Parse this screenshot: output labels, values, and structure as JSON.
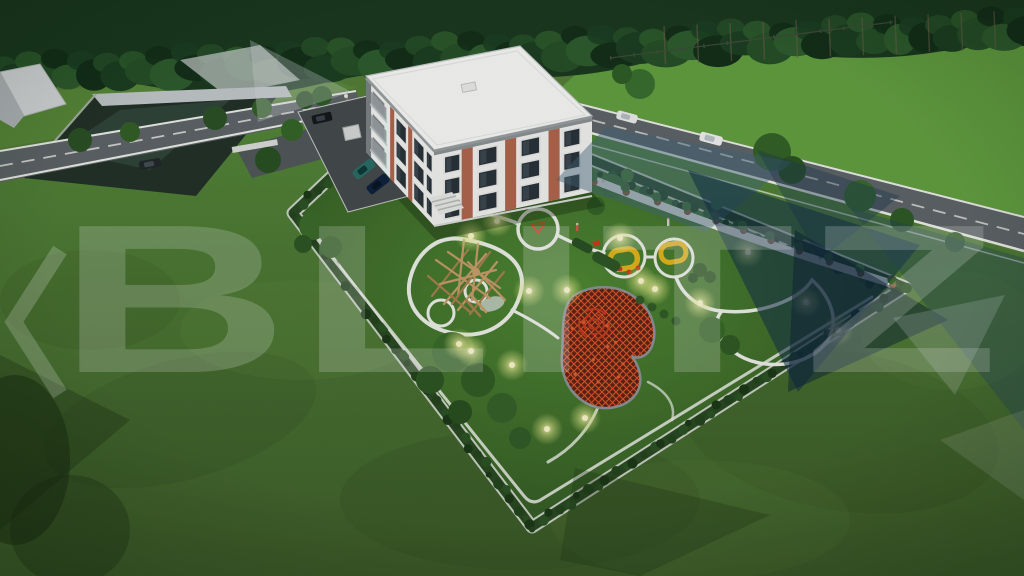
{
  "watermark": {
    "text": "BLITZ",
    "mark": "left-chevron-with-navy-triangles",
    "text_color": "#ffffff",
    "navy": "#16324a"
  },
  "colors": {
    "grass_field": "#64a041",
    "grass_lawn": "#55883a",
    "grass_foreground": "#3f5e2b",
    "garden_lawn": "#3f6c2b",
    "forest_dark": "#1c3a20",
    "road_asphalt": "#5f6568",
    "parking_asphalt": "#464b4e",
    "path_white": "#edf0e9",
    "building_white": "#f4f5f2",
    "building_trim_gray": "#85898c",
    "building_brick": "#b2674f",
    "roof_white": "#fafaf8",
    "hedge_dark": "#2a4a22",
    "play_yellow": "#e2b51e",
    "play_red": "#cf3a1f",
    "play_wood": "#c79e6a",
    "light_glow": "#f6f2ae",
    "watermark_navy": "#16324a"
  }
}
